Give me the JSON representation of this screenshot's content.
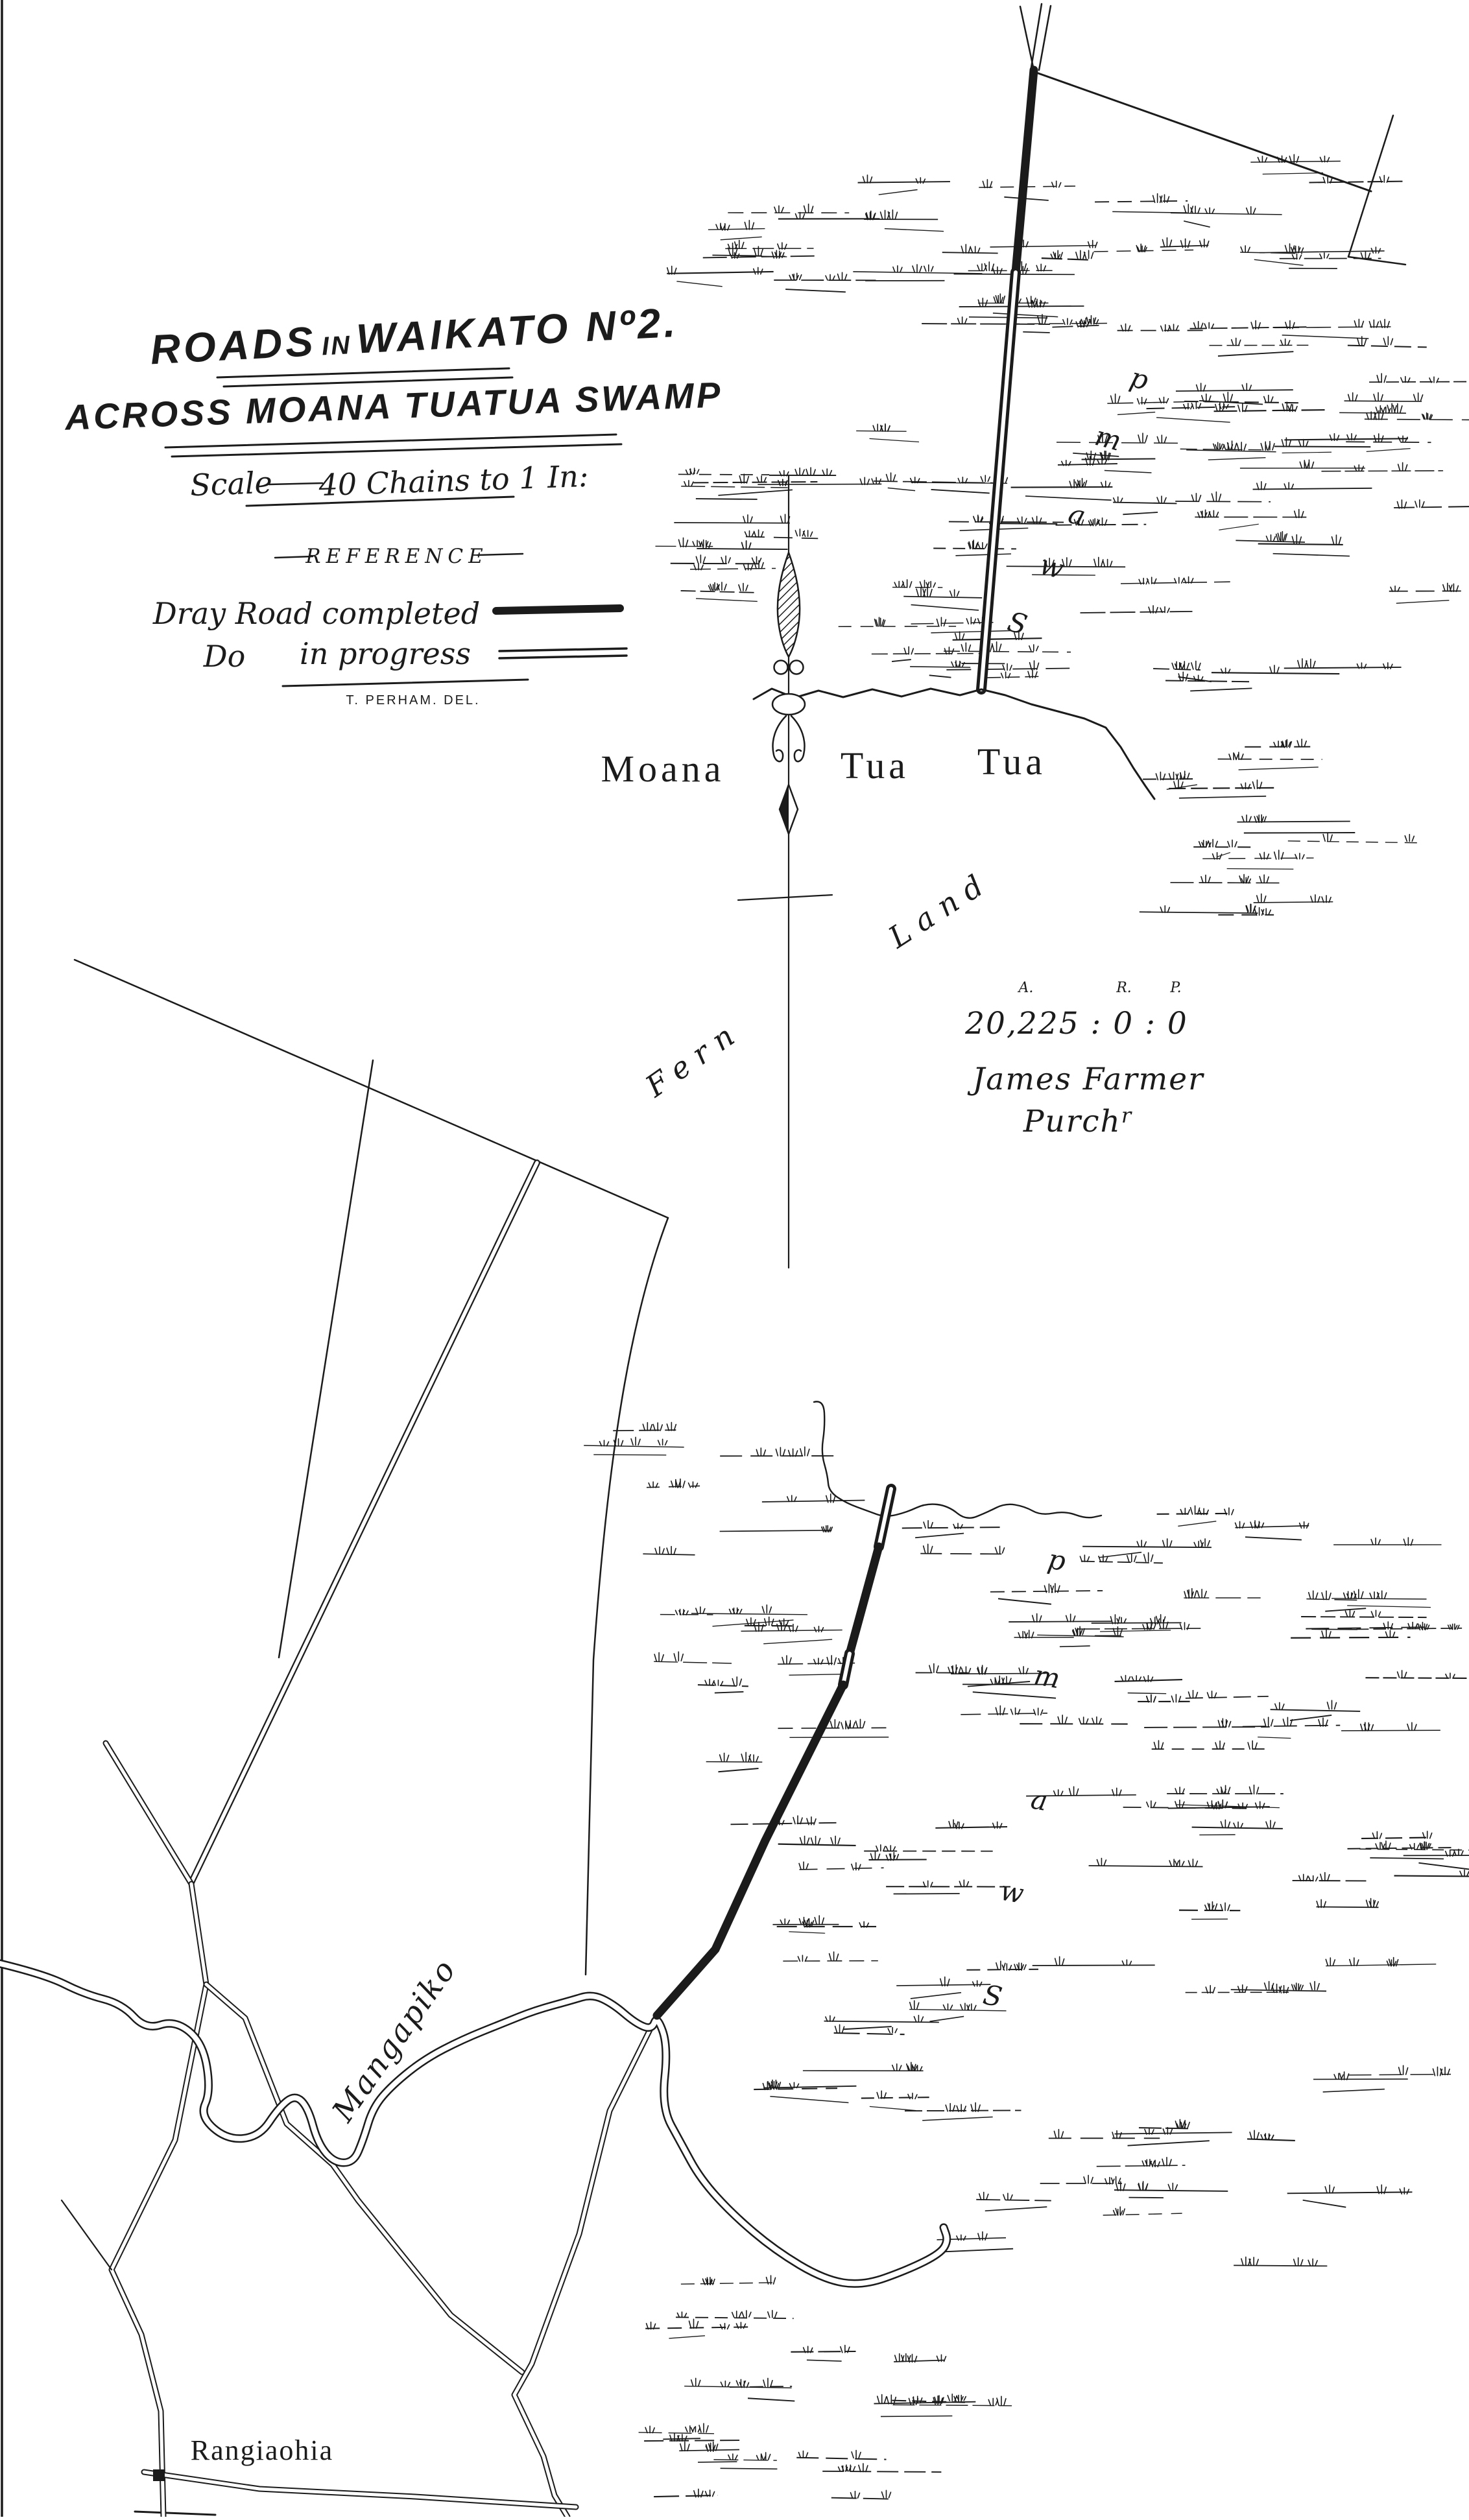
{
  "map": {
    "title": {
      "part1": "ROADS",
      "part2": "IN",
      "part3": "WAIKATO Nº2."
    },
    "subtitle": "ACROSS MOANA TUATUA SWAMP",
    "scale": {
      "label": "Scale",
      "value": "40 Chains to 1 In:"
    },
    "reference": {
      "heading": "REFERENCE",
      "item1_label": "Dray Road completed",
      "item2_label_left": "Do",
      "item2_label_right": "in progress",
      "credit": "T. PERHAM. DEL."
    },
    "labels": {
      "swamp_name_1": "Moana",
      "swamp_name_2": "Tua",
      "swamp_name_3": "Tua",
      "terrain_word_1": "Fern",
      "terrain_word_2": "Land",
      "swamp_word": "Swamp",
      "river": "Mangapiko",
      "settlement": "Rangiaohia"
    },
    "parcel": {
      "area_unit_headers": [
        "A.",
        "R.",
        "P."
      ],
      "area_value": "20,225 : 0 : 0",
      "purchaser_name": "James Farmer",
      "purchaser_title_base": "Purch",
      "purchaser_title_sup": "r"
    },
    "colors": {
      "ink": "#1b1b1b",
      "paper": "#ffffff"
    }
  }
}
